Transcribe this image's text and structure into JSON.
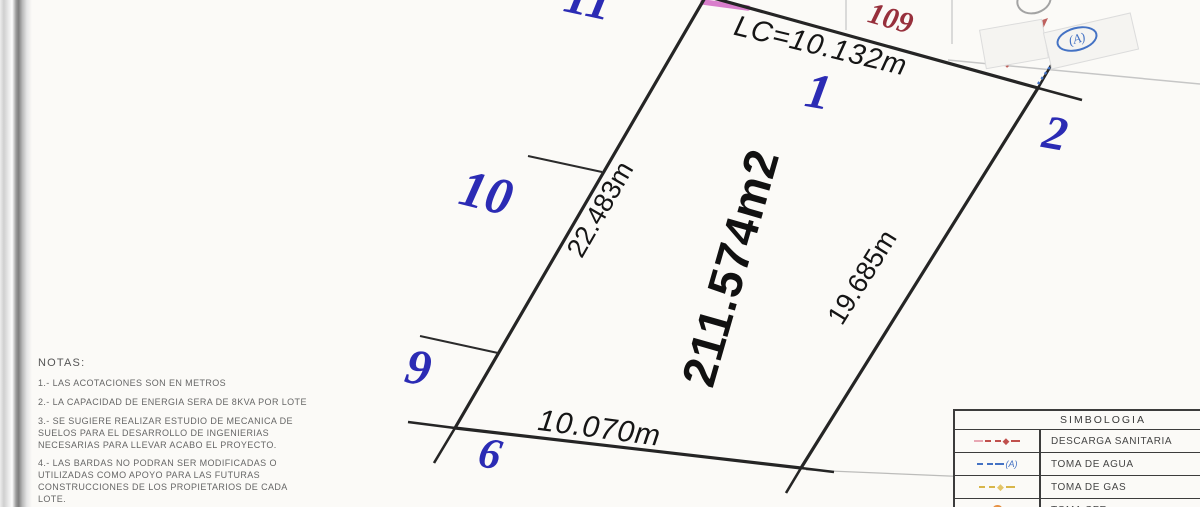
{
  "drawing": {
    "block_number": "109",
    "area_label": "211.574m2",
    "edges": {
      "top": "LC=10.132m",
      "left": "22.483m",
      "right": "19.685m",
      "bottom": "10.070m"
    },
    "lots": [
      {
        "label": "11"
      },
      {
        "label": "1"
      },
      {
        "label": "2"
      },
      {
        "label": "10"
      },
      {
        "label": "9"
      },
      {
        "label": "6"
      }
    ],
    "water_marker_label": "(A)"
  },
  "notes": {
    "title": "NOTAS:",
    "items": [
      "1.- LAS ACOTACIONES SON EN METROS",
      "2.- LA CAPACIDAD DE ENERGIA SERA DE 8KVA POR LOTE",
      "3.- SE SUGIERE REALIZAR ESTUDIO DE MECANICA DE\nSUELOS PARA EL DESARROLLO DE INGENIERIAS\nNECESARIAS PARA LLEVAR ACABO EL PROYECTO.",
      "4.- LAS BARDAS NO PODRAN SER MODIFICADAS O\nUTILIZADAS COMO APOYO PARA LAS FUTURAS\nCONSTRUCCIONES DE LOS PROPIETARIOS DE CADA\nLOTE."
    ]
  },
  "legend": {
    "title": "SIMBOLOGIA",
    "rows": [
      {
        "symbol": "descarga-sanitaria-symbol",
        "label": "DESCARGA SANITARIA"
      },
      {
        "symbol": "toma-agua-symbol",
        "label": "TOMA DE AGUA",
        "marker": "(A)"
      },
      {
        "symbol": "toma-gas-symbol",
        "label": "TOMA DE GAS"
      },
      {
        "symbol": "toma-cfe-symbol",
        "label": "TOMA CFE"
      }
    ]
  },
  "colors": {
    "lot_number_blue": "#2b2bb4",
    "dimension_black": "#151515",
    "block_red": "#97303c",
    "sanitary_red": "#c0504d",
    "water_blue": "#4472c4",
    "gas_yellow": "#d8b64a",
    "cfe_orange": "#d97b28",
    "highlight_magenta": "#d469c5"
  }
}
